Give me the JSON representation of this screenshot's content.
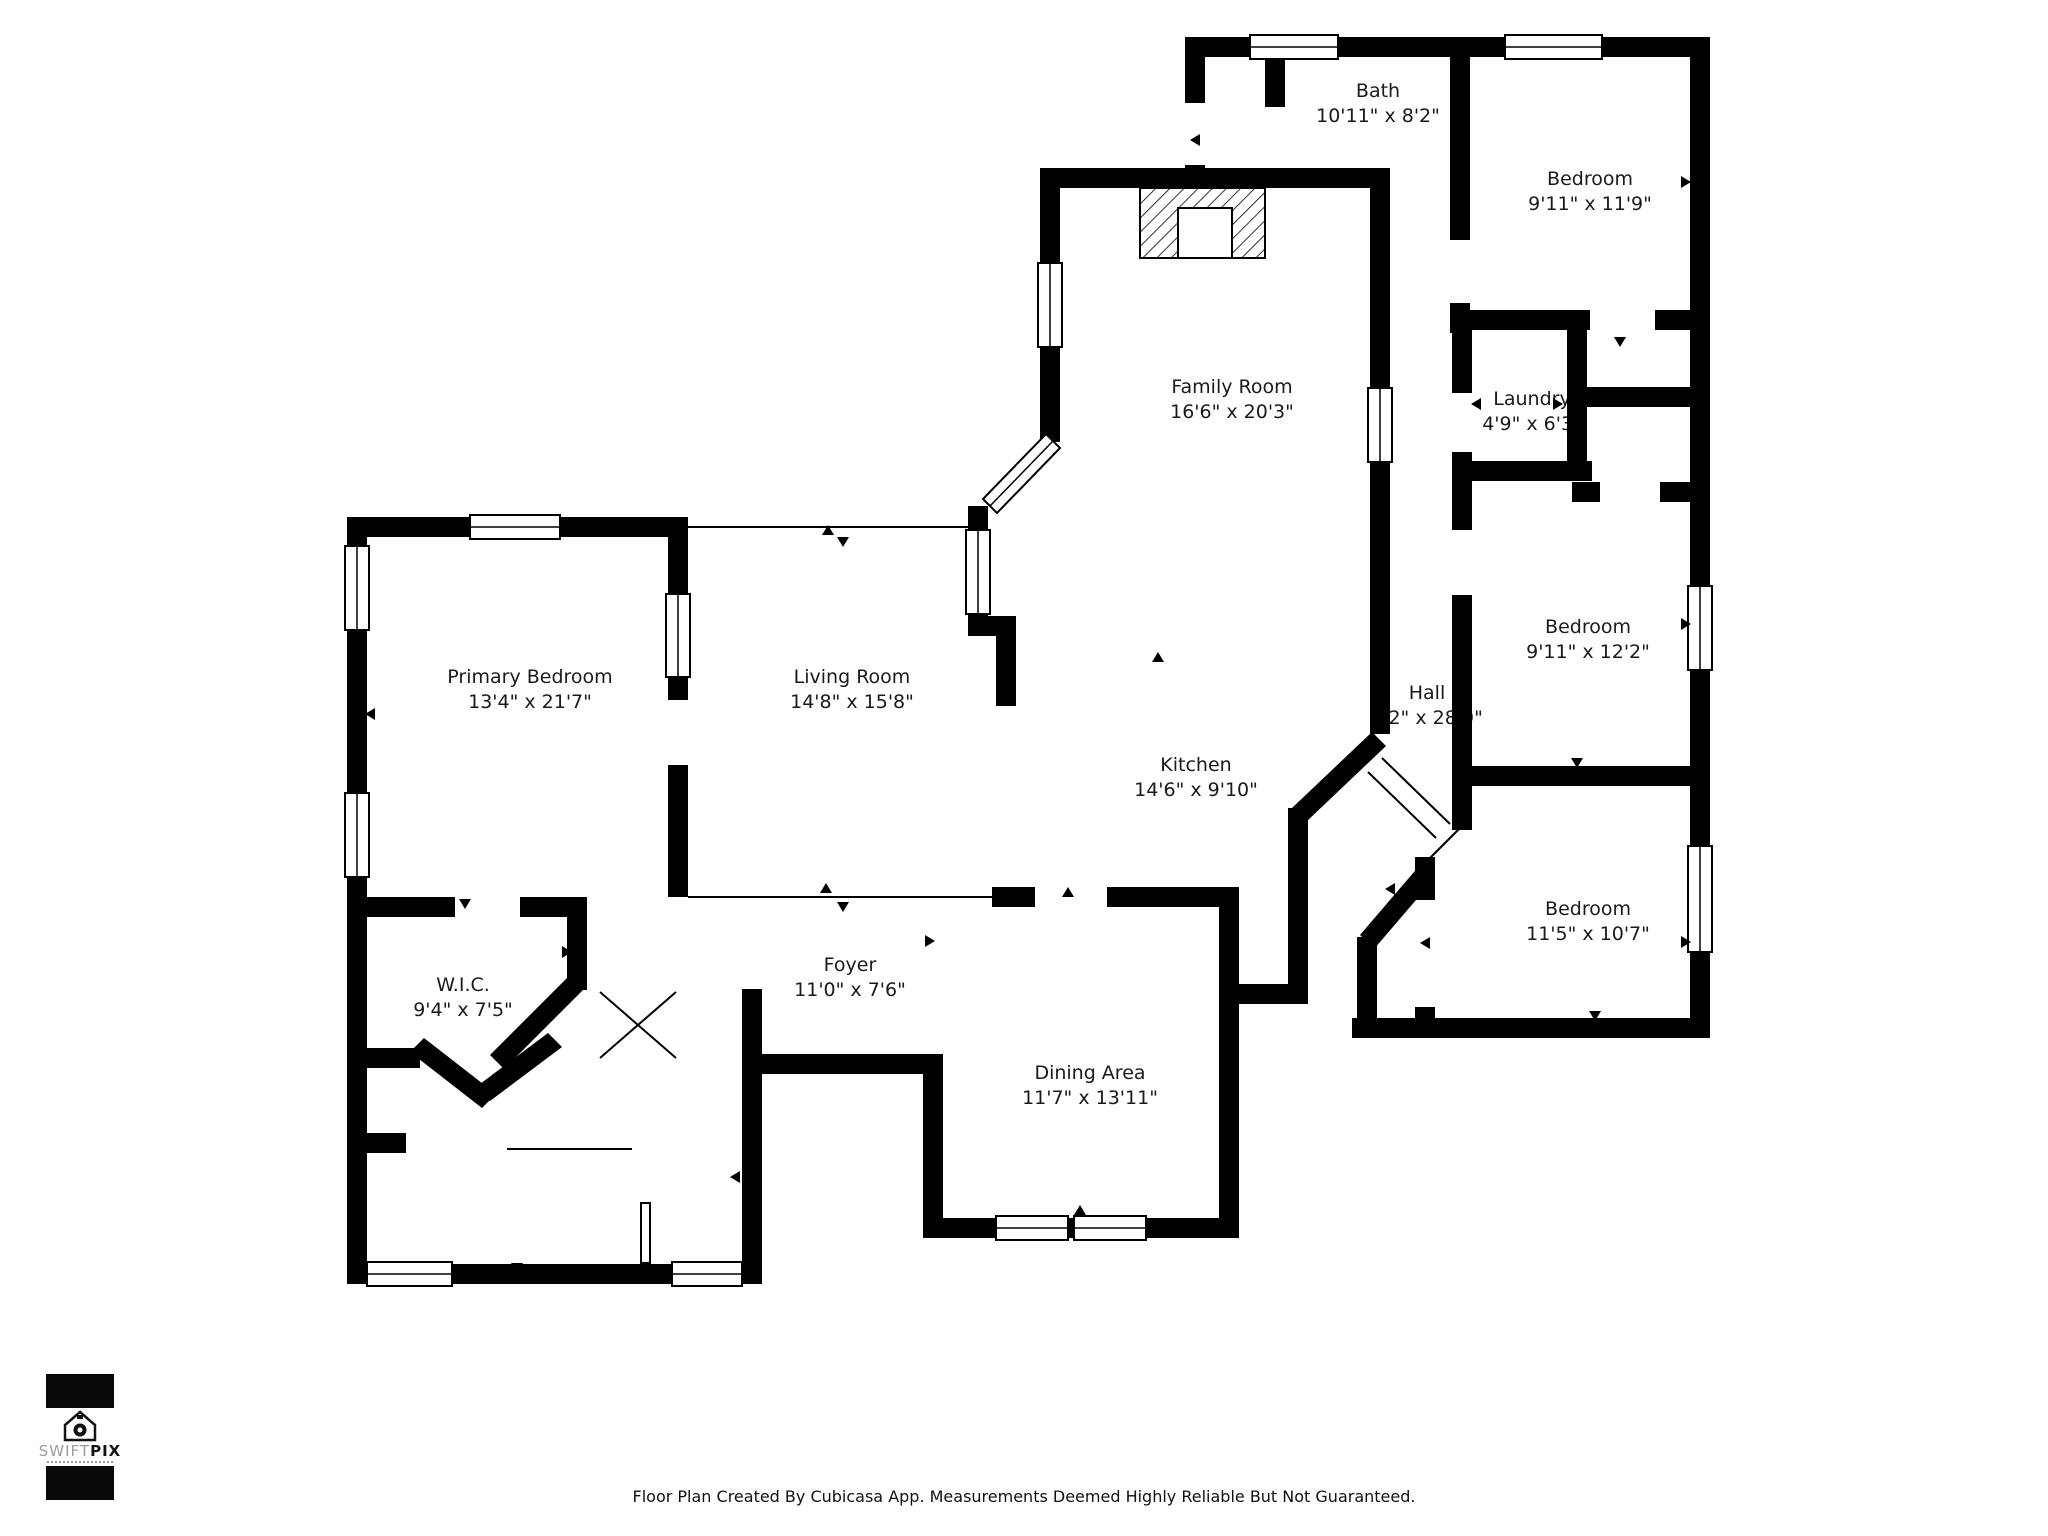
{
  "colors": {
    "wall": "#000000",
    "background": "#ffffff",
    "label_text": "#1a1a1a",
    "logo_gray": "#9b9b9b"
  },
  "rooms": [
    {
      "name": "Bath",
      "dims": "10'11\" x 8'2\""
    },
    {
      "name": "Bedroom",
      "dims": "9'11\" x 11'9\""
    },
    {
      "name": "Family Room",
      "dims": "16'6\" x 20'3\""
    },
    {
      "name": "Laundry",
      "dims": "4'9\" x 6'3\""
    },
    {
      "name": "Primary Bedroom",
      "dims": "13'4\" x 21'7\""
    },
    {
      "name": "Living Room",
      "dims": "14'8\" x 15'8\""
    },
    {
      "name": "Hall",
      "dims": "8'2\" x 28'9\""
    },
    {
      "name": "Bedroom",
      "dims": "9'11\" x 12'2\""
    },
    {
      "name": "Kitchen",
      "dims": "14'6\" x 9'10\""
    },
    {
      "name": "Bedroom",
      "dims": "11'5\" x 10'7\""
    },
    {
      "name": "W.I.C.",
      "dims": "9'4\" x 7'5\""
    },
    {
      "name": "Foyer",
      "dims": "11'0\" x 7'6\""
    },
    {
      "name": "Dining Area",
      "dims": "11'7\" x 13'11\""
    }
  ],
  "logo": {
    "word_light": "SWIFT",
    "word_bold": "PIX",
    "icon": "house-camera-icon"
  },
  "footer": {
    "text": "Floor Plan Created By Cubicasa App. Measurements Deemed Highly Reliable But Not Guaranteed."
  }
}
